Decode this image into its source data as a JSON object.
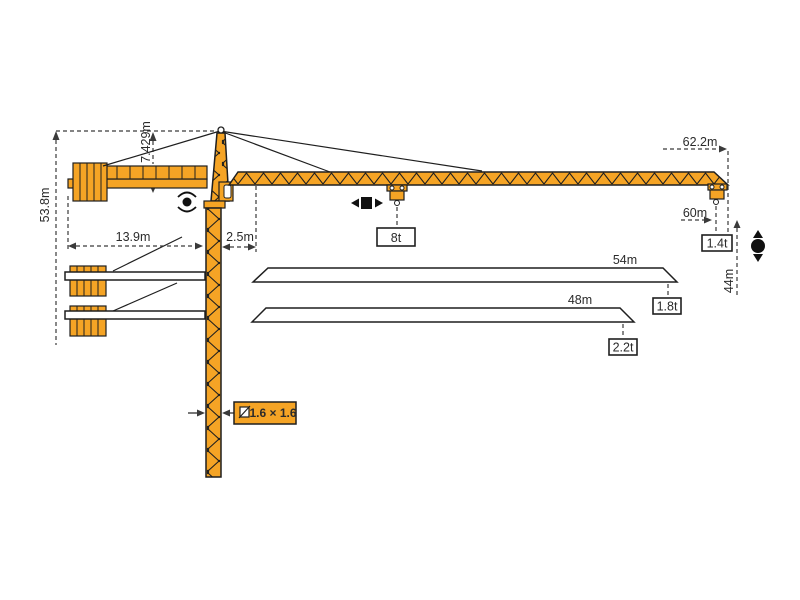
{
  "colors": {
    "crane": "#F5A425",
    "outline": "#1F1F1F",
    "dim": "#3A3A3A",
    "text": "#2B2B2B"
  },
  "labels": {
    "total_height": "53.8m",
    "tower_top_height": "7.429m",
    "counterjib_radius": "13.9m",
    "slew_offset": "2.5m",
    "max_radius": "62.2m",
    "jib_60": "60m",
    "under_hook_height": "44m",
    "jib_54": "54m",
    "jib_48": "48m",
    "mast_section": "1.6 × 1.6"
  },
  "loads": {
    "max": "8t",
    "tip_60": "1.4t",
    "tip_54": "1.8t",
    "tip_48": "2.2t"
  }
}
